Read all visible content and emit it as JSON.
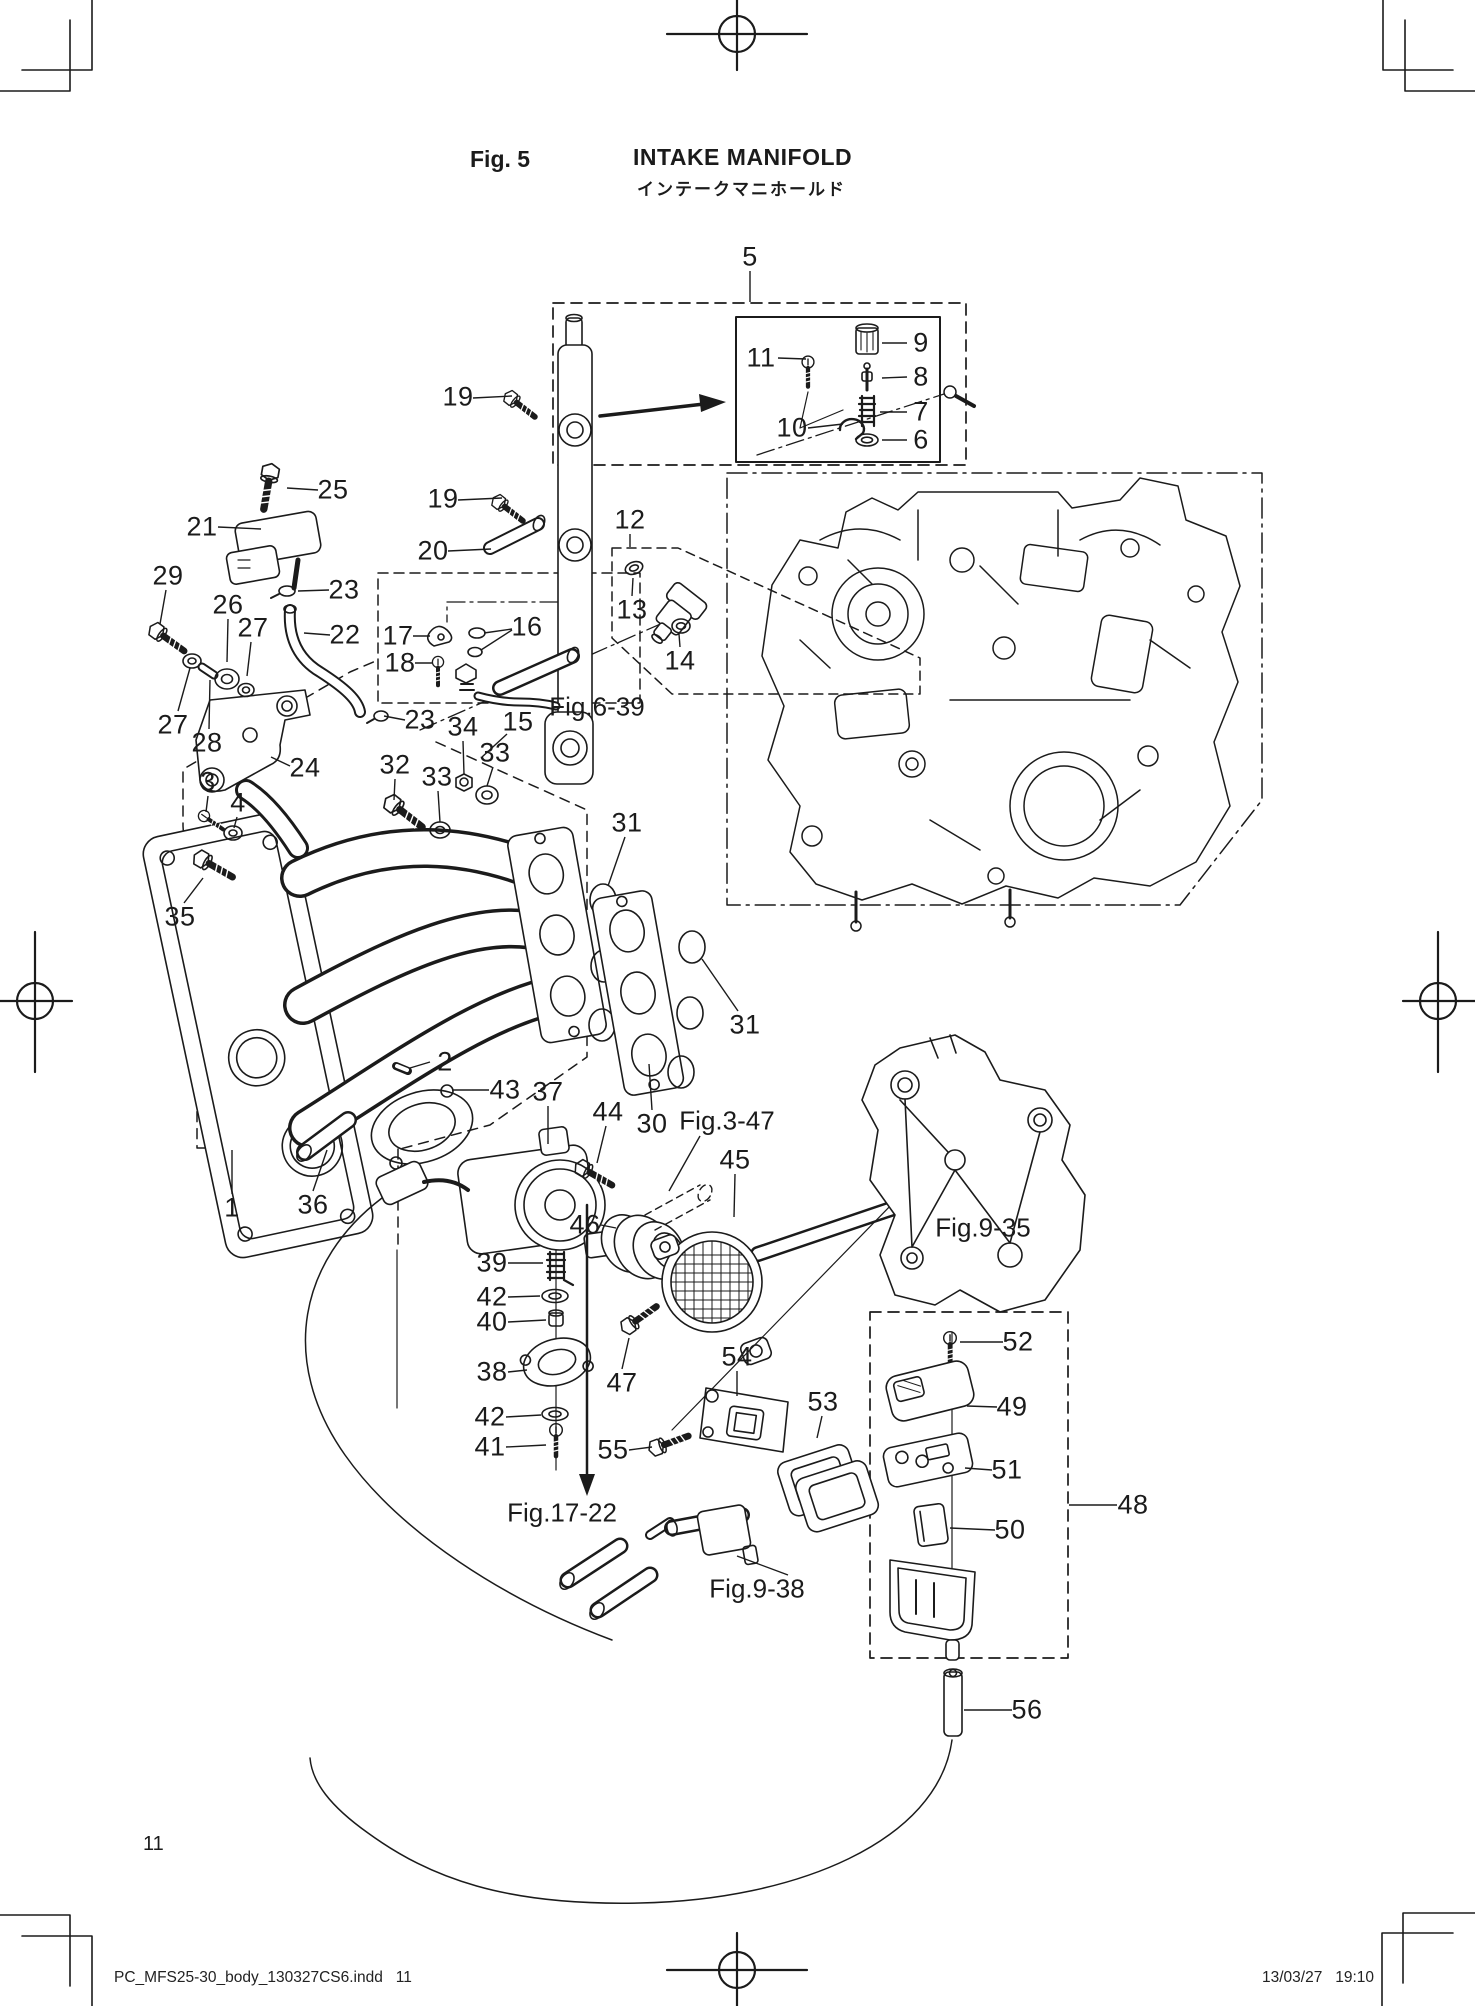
{
  "page": {
    "fig_label": "Fig. 5",
    "title_en": "INTAKE MANIFOLD",
    "title_ja": "インテークマニホールド",
    "page_number": "11",
    "footer_left": "PC_MFS25-30_body_130327CS6.indd   11",
    "footer_right": "13/03/27   19:10"
  },
  "callouts": [
    {
      "t": "5",
      "x": 750,
      "y": 257,
      "lead": [
        750,
        271,
        750,
        302
      ]
    },
    {
      "t": "11",
      "x": 761,
      "y": 358,
      "lead": [
        778,
        358,
        806,
        359
      ]
    },
    {
      "t": "9",
      "x": 921,
      "y": 343,
      "lead": [
        907,
        343,
        882,
        343
      ]
    },
    {
      "t": "8",
      "x": 921,
      "y": 377,
      "lead": [
        907,
        377,
        882,
        378
      ]
    },
    {
      "t": "7",
      "x": 921,
      "y": 412,
      "lead": [
        907,
        412,
        880,
        412
      ]
    },
    {
      "t": "6",
      "x": 921,
      "y": 440,
      "lead": [
        907,
        440,
        882,
        440
      ]
    },
    {
      "t": "10",
      "x": 792,
      "y": 428,
      "lead": [
        808,
        428,
        843,
        424
      ]
    },
    {
      "t": "19",
      "x": 458,
      "y": 397,
      "lead": [
        473,
        398,
        512,
        396
      ]
    },
    {
      "t": "25",
      "x": 333,
      "y": 490,
      "lead": [
        318,
        490,
        287,
        488
      ]
    },
    {
      "t": "21",
      "x": 202,
      "y": 527,
      "lead": [
        218,
        527,
        261,
        529
      ]
    },
    {
      "t": "19",
      "x": 443,
      "y": 499,
      "lead": [
        458,
        500,
        502,
        498
      ]
    },
    {
      "t": "20",
      "x": 433,
      "y": 551,
      "lead": [
        448,
        551,
        491,
        549
      ]
    },
    {
      "t": "12",
      "x": 630,
      "y": 520,
      "lead": [
        630,
        534,
        630,
        547
      ]
    },
    {
      "t": "13",
      "x": 632,
      "y": 610,
      "lead": [
        632,
        596,
        633,
        578
      ]
    },
    {
      "t": "14",
      "x": 680,
      "y": 661,
      "lead": [
        680,
        647,
        679,
        634
      ]
    },
    {
      "t": "29",
      "x": 168,
      "y": 576,
      "lead": [
        166,
        590,
        160,
        624
      ]
    },
    {
      "t": "26",
      "x": 228,
      "y": 605,
      "lead": [
        228,
        619,
        227,
        662
      ]
    },
    {
      "t": "27",
      "x": 253,
      "y": 628,
      "lead": [
        251,
        642,
        247,
        676
      ]
    },
    {
      "t": "23",
      "x": 344,
      "y": 590,
      "lead": [
        329,
        590,
        298,
        591
      ]
    },
    {
      "t": "22",
      "x": 345,
      "y": 635,
      "lead": [
        330,
        635,
        304,
        633
      ]
    },
    {
      "t": "17",
      "x": 398,
      "y": 636,
      "lead": [
        413,
        636,
        430,
        636
      ]
    },
    {
      "t": "18",
      "x": 400,
      "y": 663,
      "lead": [
        415,
        663,
        432,
        663
      ]
    },
    {
      "t": "16",
      "x": 527,
      "y": 627,
      "lead": [
        512,
        629,
        484,
        633
      ],
      "lead2": [
        512,
        630,
        481,
        650
      ]
    },
    {
      "t": "27",
      "x": 173,
      "y": 725,
      "lead": [
        178,
        711,
        190,
        668
      ]
    },
    {
      "t": "28",
      "x": 207,
      "y": 743,
      "lead": [
        209,
        729,
        210,
        680
      ]
    },
    {
      "t": "24",
      "x": 305,
      "y": 768,
      "lead": [
        290,
        766,
        271,
        757
      ]
    },
    {
      "t": "23",
      "x": 420,
      "y": 720,
      "lead": [
        405,
        720,
        384,
        716
      ]
    },
    {
      "t": "34",
      "x": 463,
      "y": 727,
      "lead": [
        463,
        741,
        464,
        774
      ]
    },
    {
      "t": "15",
      "x": 518,
      "y": 722,
      "lead": [
        507,
        734,
        482,
        757
      ]
    },
    {
      "t": "33",
      "x": 495,
      "y": 753,
      "lead": [
        493,
        767,
        487,
        786
      ]
    },
    {
      "t": "32",
      "x": 395,
      "y": 765,
      "lead": [
        395,
        779,
        394,
        800
      ]
    },
    {
      "t": "33",
      "x": 437,
      "y": 777,
      "lead": [
        438,
        791,
        440,
        822
      ]
    },
    {
      "t": "3",
      "x": 208,
      "y": 782,
      "lead": [
        208,
        796,
        206,
        812
      ]
    },
    {
      "t": "4",
      "x": 238,
      "y": 803,
      "lead": [
        237,
        817,
        234,
        828
      ]
    },
    {
      "t": "35",
      "x": 180,
      "y": 917,
      "lead": [
        184,
        903,
        203,
        878
      ]
    },
    {
      "t": "31",
      "x": 627,
      "y": 823,
      "lead": [
        625,
        837,
        608,
        886
      ]
    },
    {
      "t": "31",
      "x": 745,
      "y": 1025,
      "lead": [
        738,
        1011,
        702,
        959
      ]
    },
    {
      "t": "2",
      "x": 445,
      "y": 1062,
      "lead": [
        430,
        1062,
        410,
        1068
      ]
    },
    {
      "t": "43",
      "x": 505,
      "y": 1090,
      "lead": [
        489,
        1090,
        452,
        1090
      ]
    },
    {
      "t": "37",
      "x": 548,
      "y": 1092,
      "lead": [
        548,
        1106,
        548,
        1144
      ]
    },
    {
      "t": "44",
      "x": 608,
      "y": 1112,
      "lead": [
        606,
        1126,
        597,
        1163
      ]
    },
    {
      "t": "30",
      "x": 652,
      "y": 1124,
      "lead": [
        652,
        1110,
        649,
        1064
      ]
    },
    {
      "t": "45",
      "x": 735,
      "y": 1160,
      "lead": [
        735,
        1174,
        734,
        1217
      ]
    },
    {
      "t": "46",
      "x": 585,
      "y": 1225,
      "lead": [
        601,
        1225,
        616,
        1228
      ]
    },
    {
      "t": "1",
      "x": 232,
      "y": 1208,
      "lead": [
        232,
        1194,
        232,
        1150
      ]
    },
    {
      "t": "36",
      "x": 313,
      "y": 1205,
      "lead": [
        313,
        1191,
        327,
        1150
      ]
    },
    {
      "t": "39",
      "x": 492,
      "y": 1263,
      "lead": [
        508,
        1263,
        543,
        1263
      ]
    },
    {
      "t": "42",
      "x": 492,
      "y": 1297,
      "lead": [
        508,
        1297,
        540,
        1296
      ]
    },
    {
      "t": "40",
      "x": 492,
      "y": 1322,
      "lead": [
        508,
        1322,
        546,
        1320
      ]
    },
    {
      "t": "38",
      "x": 492,
      "y": 1372,
      "lead": [
        508,
        1372,
        527,
        1370
      ]
    },
    {
      "t": "47",
      "x": 622,
      "y": 1383,
      "lead": [
        622,
        1369,
        629,
        1338
      ]
    },
    {
      "t": "54",
      "x": 737,
      "y": 1357,
      "lead": [
        737,
        1371,
        737,
        1396
      ]
    },
    {
      "t": "53",
      "x": 823,
      "y": 1402,
      "lead": [
        822,
        1416,
        817,
        1438
      ]
    },
    {
      "t": "55",
      "x": 613,
      "y": 1450,
      "lead": [
        629,
        1450,
        652,
        1447
      ]
    },
    {
      "t": "42",
      "x": 490,
      "y": 1417,
      "lead": [
        506,
        1417,
        541,
        1415
      ]
    },
    {
      "t": "41",
      "x": 490,
      "y": 1447,
      "lead": [
        506,
        1447,
        546,
        1445
      ]
    },
    {
      "t": "52",
      "x": 1018,
      "y": 1342,
      "lead": [
        1003,
        1342,
        960,
        1342
      ]
    },
    {
      "t": "49",
      "x": 1012,
      "y": 1407,
      "lead": [
        997,
        1407,
        967,
        1406
      ]
    },
    {
      "t": "51",
      "x": 1007,
      "y": 1470,
      "lead": [
        992,
        1470,
        965,
        1468
      ]
    },
    {
      "t": "48",
      "x": 1133,
      "y": 1505,
      "lead": [
        1117,
        1505,
        1069,
        1505
      ]
    },
    {
      "t": "50",
      "x": 1010,
      "y": 1530,
      "lead": [
        995,
        1530,
        950,
        1528
      ]
    },
    {
      "t": "56",
      "x": 1027,
      "y": 1710,
      "lead": [
        1012,
        1710,
        964,
        1710
      ]
    }
  ],
  "fig_refs": [
    {
      "t": "Fig.6-39",
      "x": 597,
      "y": 707
    },
    {
      "t": "Fig.3-47",
      "x": 727,
      "y": 1121,
      "lead": [
        700,
        1136,
        669,
        1191
      ]
    },
    {
      "t": "Fig.9-35",
      "x": 983,
      "y": 1228
    },
    {
      "t": "Fig.17-22",
      "x": 562,
      "y": 1513
    },
    {
      "t": "Fig.9-38",
      "x": 757,
      "y": 1589,
      "lead": [
        788,
        1575,
        737,
        1556
      ]
    }
  ]
}
